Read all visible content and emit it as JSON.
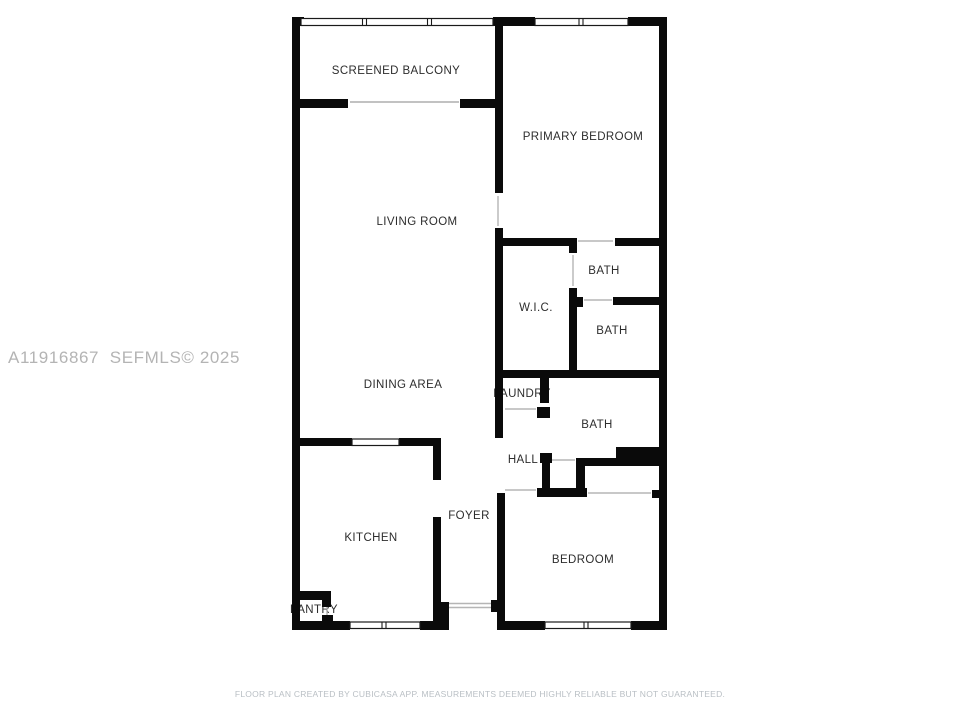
{
  "floor_plan": {
    "rooms": [
      {
        "name": "SCREENED BALCONY"
      },
      {
        "name": "PRIMARY BEDROOM"
      },
      {
        "name": "LIVING ROOM"
      },
      {
        "name": "BATH"
      },
      {
        "name": "W.I.C."
      },
      {
        "name": "BATH"
      },
      {
        "name": "DINING AREA"
      },
      {
        "name": "LAUNDRY"
      },
      {
        "name": "BATH"
      },
      {
        "name": "HALL"
      },
      {
        "name": "FOYER"
      },
      {
        "name": "KITCHEN"
      },
      {
        "name": "BEDROOM"
      },
      {
        "name": "PANTRY"
      }
    ]
  },
  "watermark": {
    "text": "A11916867  SEFMLS© 2025"
  },
  "footer": {
    "text": "FLOOR PLAN CREATED BY CUBICASA APP. MEASUREMENTS DEEMED HIGHLY RELIABLE BUT NOT GUARANTEED."
  },
  "colors": {
    "wall": "#0a0a0a",
    "label": "#2d2d2d",
    "watermark": "#b4b4b4",
    "footer": "#b9bfc4",
    "background": "#ffffff"
  }
}
